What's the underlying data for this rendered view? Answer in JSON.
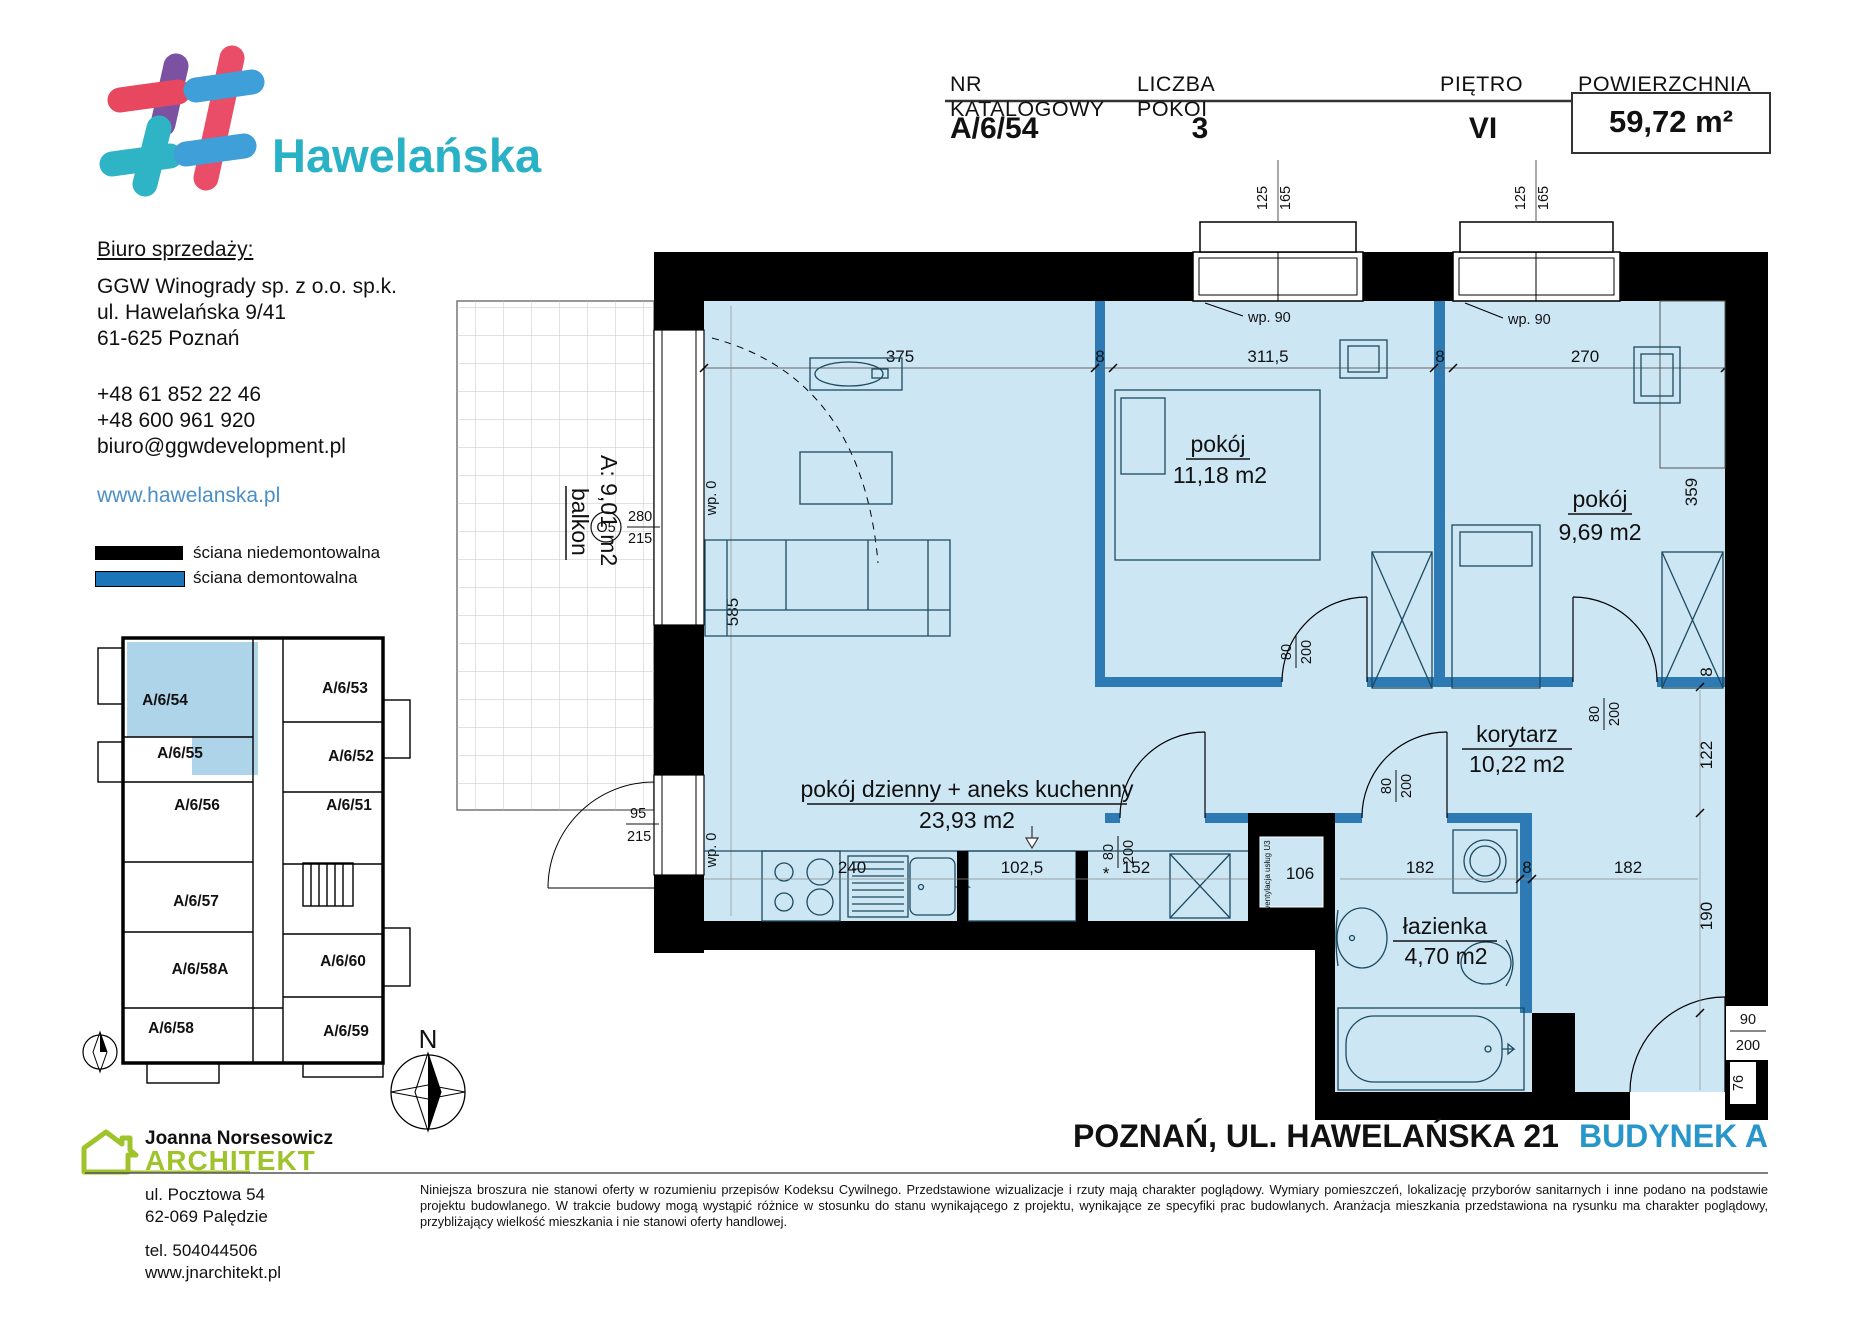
{
  "brand": {
    "name": "Hawelańska"
  },
  "unit_table": {
    "col1": "NR KATALOGOWY",
    "col2": "LICZBA POKOI",
    "col3": "PIĘTRO",
    "col4": "POWIERZCHNIA",
    "catalog_no": "A/6/54",
    "rooms": "3",
    "floor": "VI",
    "area": "59,72 m²"
  },
  "sales_office": {
    "heading": "Biuro sprzedaży:",
    "company": "GGW Winogrady sp. z o.o. sp.k.",
    "street": "ul. Hawelańska 9/41",
    "city": "61-625 Poznań",
    "phone1": "+48 61 852 22 46",
    "phone2": "+48 600 961 920",
    "email": "biuro@ggwdevelopment.pl",
    "website": "www.hawelanska.pl"
  },
  "legend": {
    "wall_fixed": "ściana niedemontowalna",
    "wall_removable": "ściana demontowalna"
  },
  "mini_plan": {
    "units": [
      "A/6/54",
      "A/6/53",
      "A/6/55",
      "A/6/52",
      "A/6/56",
      "A/6/51",
      "A/6/57",
      "A/6/58A",
      "A/6/60",
      "A/6/58",
      "A/6/59"
    ]
  },
  "compass": {
    "north": "N"
  },
  "plan": {
    "rooms": {
      "living": {
        "name": "pokój dzienny + aneks kuchenny",
        "area": "23,93 m2"
      },
      "bedroom1": {
        "name": "pokój",
        "area": "11,18 m2"
      },
      "bedroom2": {
        "name": "pokój",
        "area": "9,69 m2"
      },
      "corridor": {
        "name": "korytarz",
        "area": "10,22 m2"
      },
      "bathroom": {
        "name": "łazienka",
        "area": "4,70 m2"
      },
      "balcony": {
        "name": "balkon",
        "area": "A: 9,01 m2"
      }
    },
    "labels": {
      "wp90": "wp. 90",
      "wp0": "wp. 0",
      "o5": "O5",
      "vent": "wentylacja usług U3",
      "star": "*"
    },
    "door": {
      "w": "80",
      "h": "200"
    },
    "entrance_door": {
      "w": "90",
      "h": "200"
    },
    "dims": {
      "living_w": "375",
      "wall_a": "8",
      "bed1_w": "311,5",
      "wall_b": "8",
      "bed2_w": "270",
      "win_w": "125",
      "win_h": "165",
      "living_h": "585",
      "bal_win_w": "280",
      "bal_win_h": "215",
      "bal_door_w": "95",
      "bal_door_h": "215",
      "bed_depth": "359",
      "wall_c": "8",
      "cor_h": "122",
      "bath_side": "190",
      "ent_side": "76",
      "kitchen_a": "240",
      "kitchen_b": "102,5",
      "kitchen_c": "152",
      "shaft": "106",
      "bath_w": "182",
      "wall_d": "8",
      "hall_w": "182"
    }
  },
  "footer": {
    "city_line": "POZNAŃ, UL. HAWELAŃSKA 21",
    "building": "BUDYNEK A",
    "architect_name": "Joanna Norsesowicz",
    "architect_title": "ARCHITEKT",
    "architect_street": "ul. Pocztowa 54",
    "architect_city": "62-069 Palędzie",
    "architect_phone": "tel. 504044506",
    "architect_web": "www.jnarchitekt.pl",
    "disclaimer": "Niniejsza broszura nie stanowi oferty w rozumieniu przepisów Kodeksu Cywilnego. Przedstawione wizualizacje i rzuty mają charakter poglądowy. Wymiary pomieszczeń, lokalizację przyborów sanitarnych i inne podano na podstawie projektu budowlanego. W trakcie budowy mogą wystąpić różnice w stosunku do stanu wynikającego z projektu, wynikające ze specyfiki prac budowlanych. Aranżacja mieszkania przedstawiona na rysunku ma charakter poglądowy, przybliżający wielkość mieszkania i nie stanowi oferty handlowej."
  }
}
